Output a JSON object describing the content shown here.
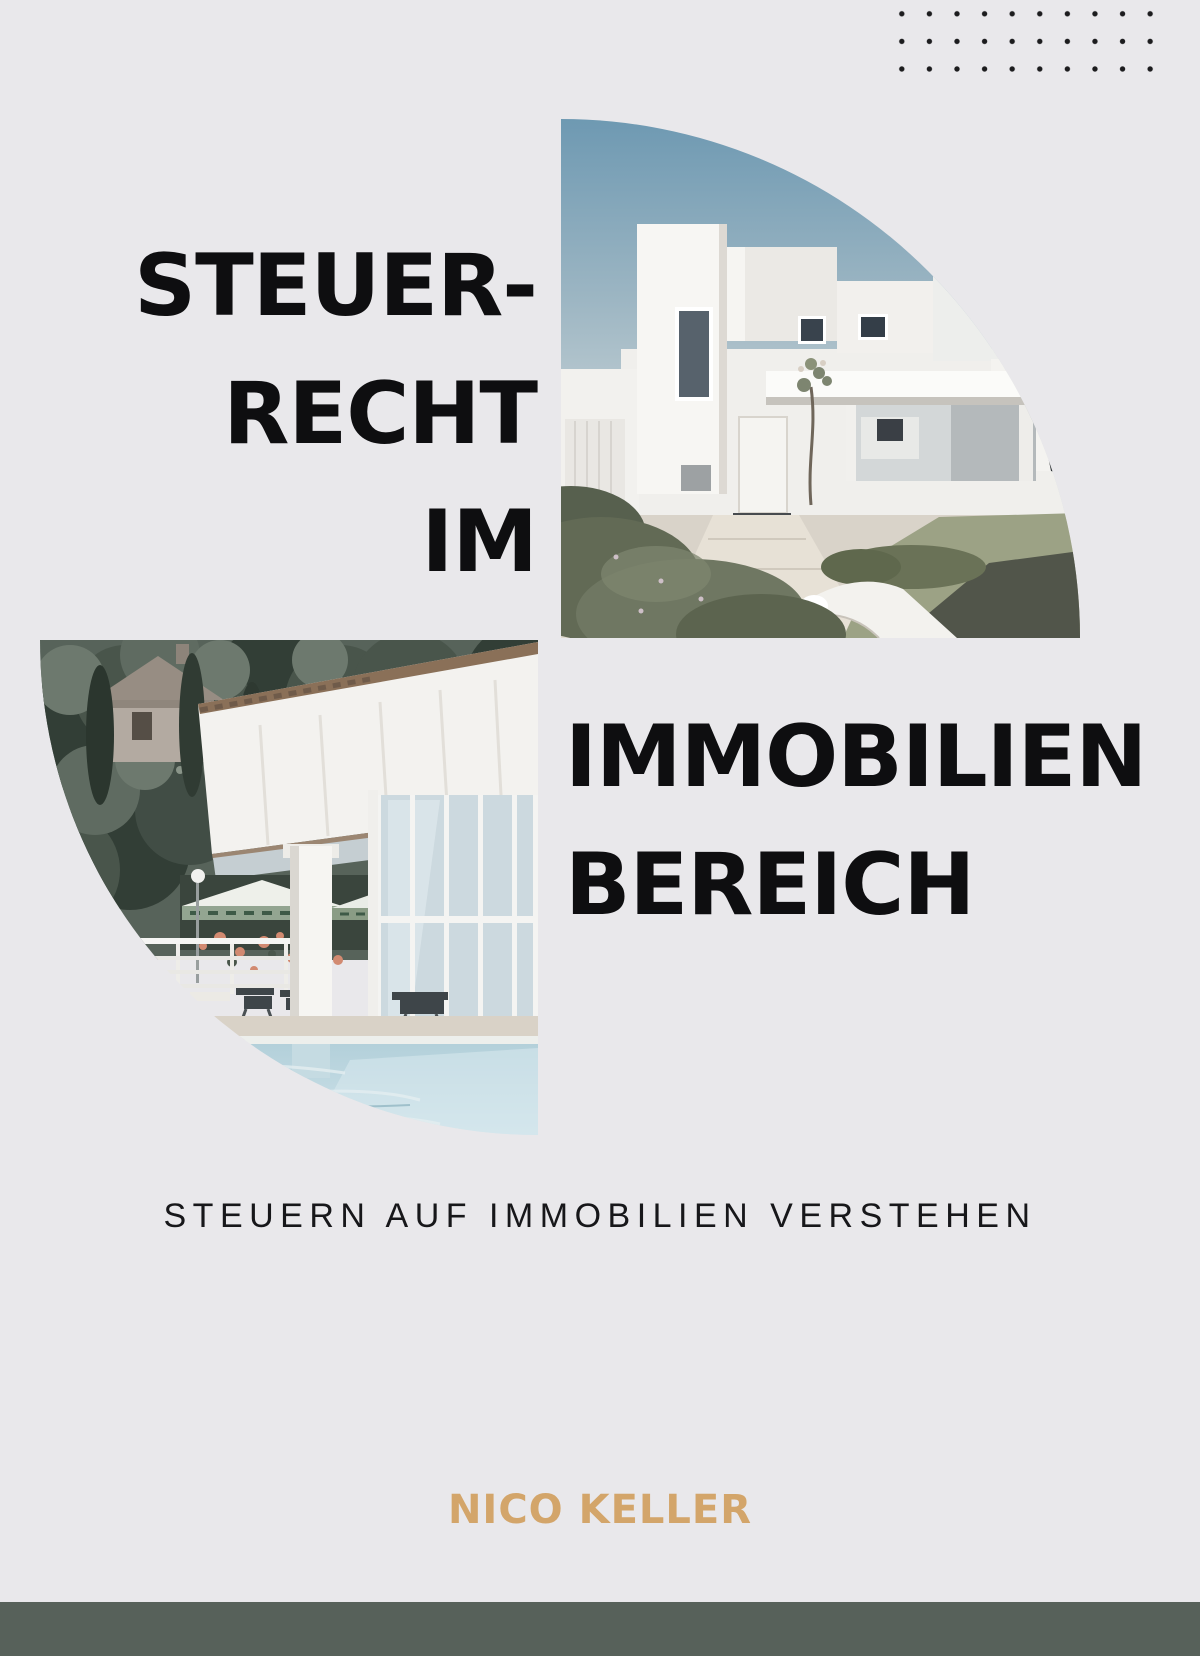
{
  "page": {
    "background_color": "#e9e8eb",
    "kind": "book-cover"
  },
  "decor": {
    "dot_grid": {
      "rows": 3,
      "cols": 10,
      "dot_color": "#1c1c1e"
    }
  },
  "title": {
    "color": "#0e0e10",
    "left_lines": {
      "0": "STEUER-",
      "1": "RECHT",
      "2": "IM"
    },
    "right_lines": {
      "0": "IMMOBILIEN",
      "1": "BEREICH"
    }
  },
  "subtitle": {
    "text": "STEUERN AUF IMMOBILIEN VERSTEHEN",
    "color": "#17171a"
  },
  "author": {
    "name": "NICO KELLER",
    "color": "#d3a56a"
  },
  "footer": {
    "color": "#57615a"
  },
  "images": {
    "top_right": {
      "alt": "modern white cubic house with garden, quarter-circle crop"
    },
    "bottom_left": {
      "alt": "poolside building with trees and umbrellas, quarter-circle crop"
    }
  }
}
